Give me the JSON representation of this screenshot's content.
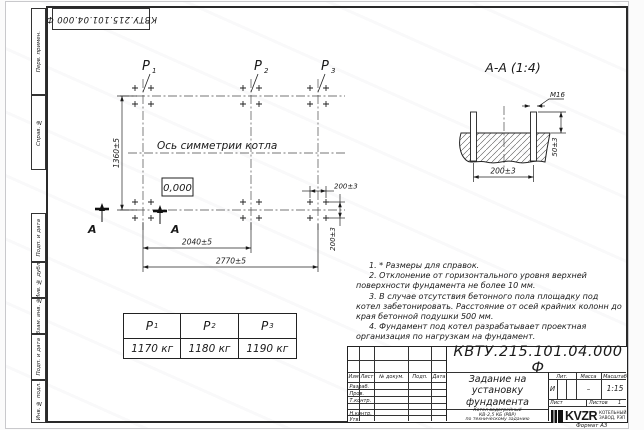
{
  "sheet": {
    "corner_designation": "КВТУ.215.101.04.000 Ф",
    "format_note": "Формат А3",
    "margin_labels": [
      "Перв. примен.",
      "Справ. №",
      "Подп. и дата",
      "Инв. № дубл.",
      "Взам. инв. №",
      "Подп. и дата",
      "Инв. № подл."
    ]
  },
  "plan": {
    "axis_label": "Ось симметрии котла",
    "level_mark": "0,000",
    "section_letter": "А",
    "dim_height": "1360±5",
    "dim_p1_p2": "2040±5",
    "dim_p1_p3": "2770±5",
    "dim_bolt_h": "200±3",
    "dim_bolt_v": "200±3"
  },
  "loads": [
    {
      "sym": "Р",
      "sub": "1",
      "value": "1170 кг"
    },
    {
      "sym": "Р",
      "sub": "2",
      "value": "1180 кг"
    },
    {
      "sym": "Р",
      "sub": "3",
      "value": "1190 кг"
    }
  ],
  "section_view": {
    "title": "А-А (1:4)",
    "thread": "М16",
    "dim_spacing": "200±3",
    "dim_height": "50±3"
  },
  "notes": [
    "1. * Размеры для справок.",
    "2. Отклонение от горизонтального уровня верхней поверхности фундамента не более 10 мм.",
    "3. В случае отсутствия бетонного пола площадку под котел забетонировать. Расстояние от осей крайних колонн до края бетонной подушки 500 мм.",
    "4. Фундамент под котел разрабатывает проектная организация по нагрузкам на фундамент."
  ],
  "title_block": {
    "designation": "КВТУ.215.101.04.000 Ф",
    "doc_title_lines": [
      "Задание на",
      "установку",
      "фундамента"
    ],
    "product_lines": [
      "Котел водогрейный",
      "КВ-2,5 КБ (РВР)",
      "по техническому заданию"
    ],
    "col_headers": [
      "Изм.",
      "Лист",
      "№ докум.",
      "Подп.",
      "Дата"
    ],
    "row_labels": [
      "Разраб.",
      "Пров.",
      "Т.контр.",
      "Н.контр.",
      "Утв."
    ],
    "lit_header": "Лит.",
    "mass_header": "Масса",
    "scale_header": "Масштаб",
    "lit_value": "И",
    "mass_value": "–",
    "scale_value": "1:15",
    "sheet_header": "Лист",
    "sheets_header": "Листов",
    "sheets_value": "1",
    "logo_text": "KVZR",
    "logo_caption_lines": [
      "КОТЕЛЬНЫЙ",
      "ЗАВОД, РЭП"
    ]
  }
}
